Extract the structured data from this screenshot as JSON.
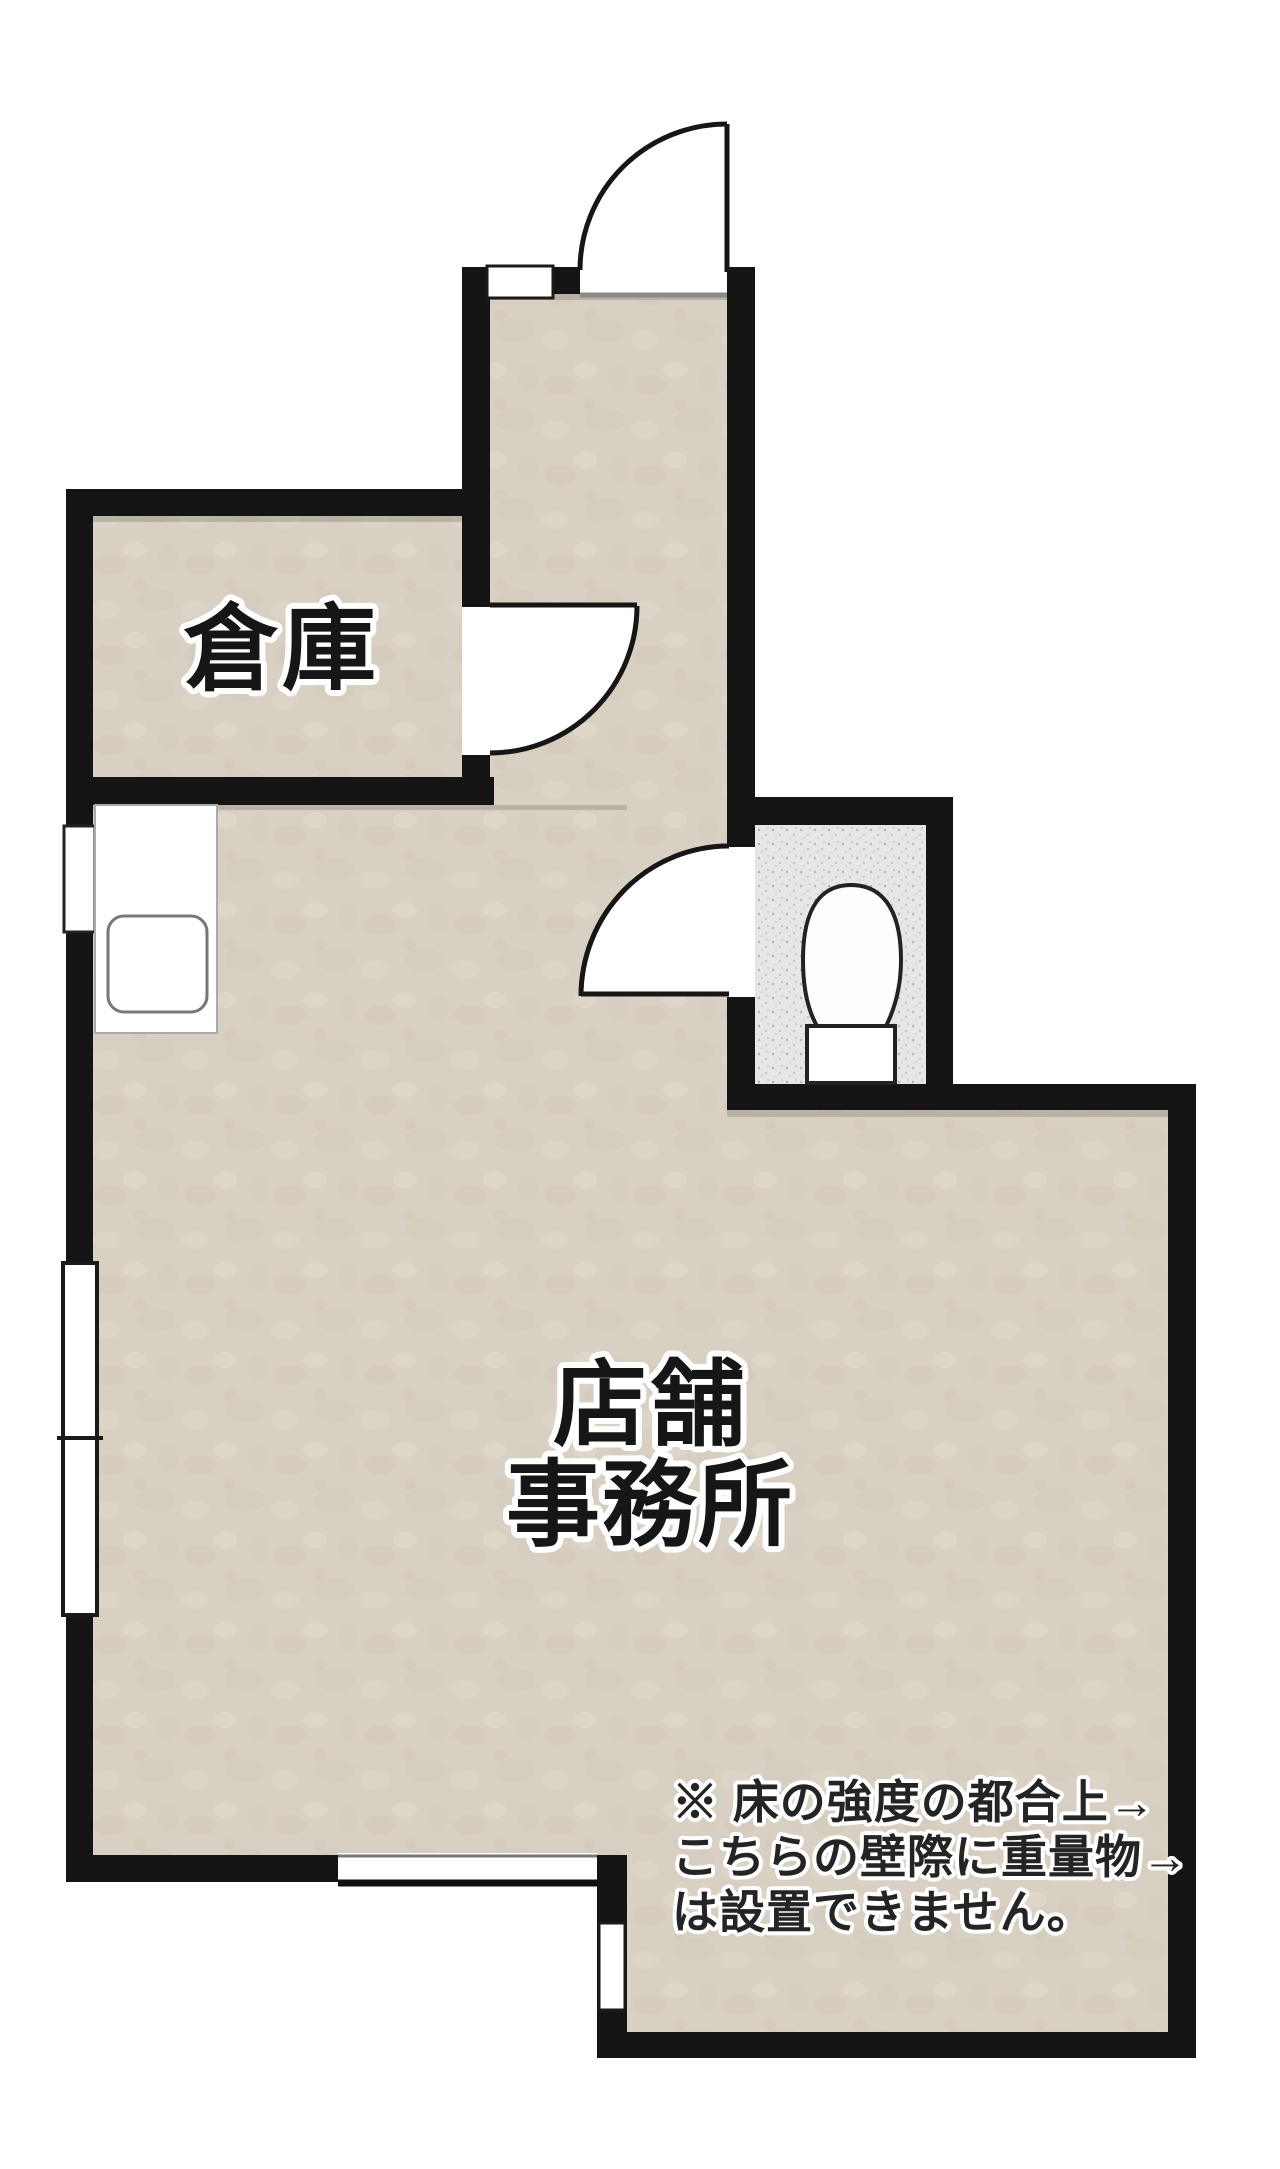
{
  "plan": {
    "rooms": {
      "storage": {
        "label": "倉庫"
      },
      "shop_office": {
        "label_line1": "店舗",
        "label_line2": "事務所"
      },
      "toilet": {
        "fixture": "toilet"
      }
    },
    "note": {
      "line1": "※ 床の強度の都合上→",
      "line2": "こちらの壁際に重量物→",
      "line3": "は設置できません。"
    },
    "colors": {
      "wall": "#141414",
      "floor_beige": "#d8d0c2",
      "toilet_gray": "#e6e6e6",
      "background": "#ffffff",
      "label_text": "#161616"
    }
  }
}
